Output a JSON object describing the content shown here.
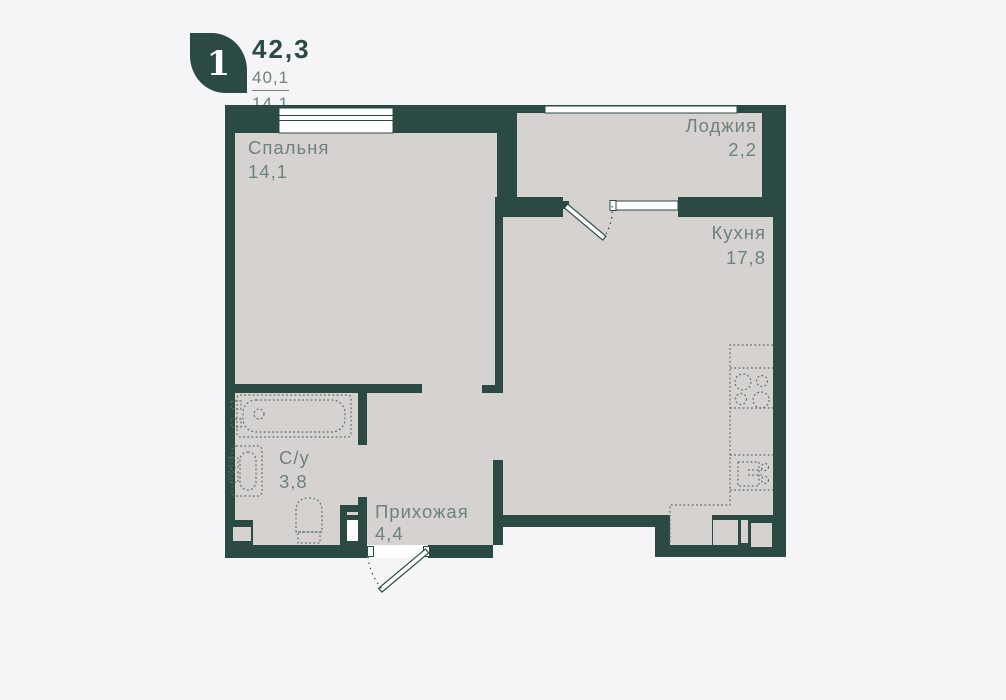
{
  "header": {
    "rooms_badge": "1",
    "total_area": "42,3",
    "living_area": "40,1",
    "room_area": "14,1"
  },
  "rooms": [
    {
      "id": "bedroom",
      "label": "Спальня",
      "area": "14,1"
    },
    {
      "id": "loggia",
      "label": "Лоджия",
      "area": "2,2"
    },
    {
      "id": "kitchen",
      "label": "Кухня",
      "area": "17,8"
    },
    {
      "id": "bathroom",
      "label": "С/у",
      "area": "3,8"
    },
    {
      "id": "hallway",
      "label": "Прихожая",
      "area": "4,4"
    }
  ],
  "colors": {
    "wall": "#2b4a43",
    "floor": "#d6d2d0",
    "background": "#f5f4f6",
    "fixture_stroke": "#587068",
    "label_text": "#6f827b",
    "window": "#ffffff"
  }
}
